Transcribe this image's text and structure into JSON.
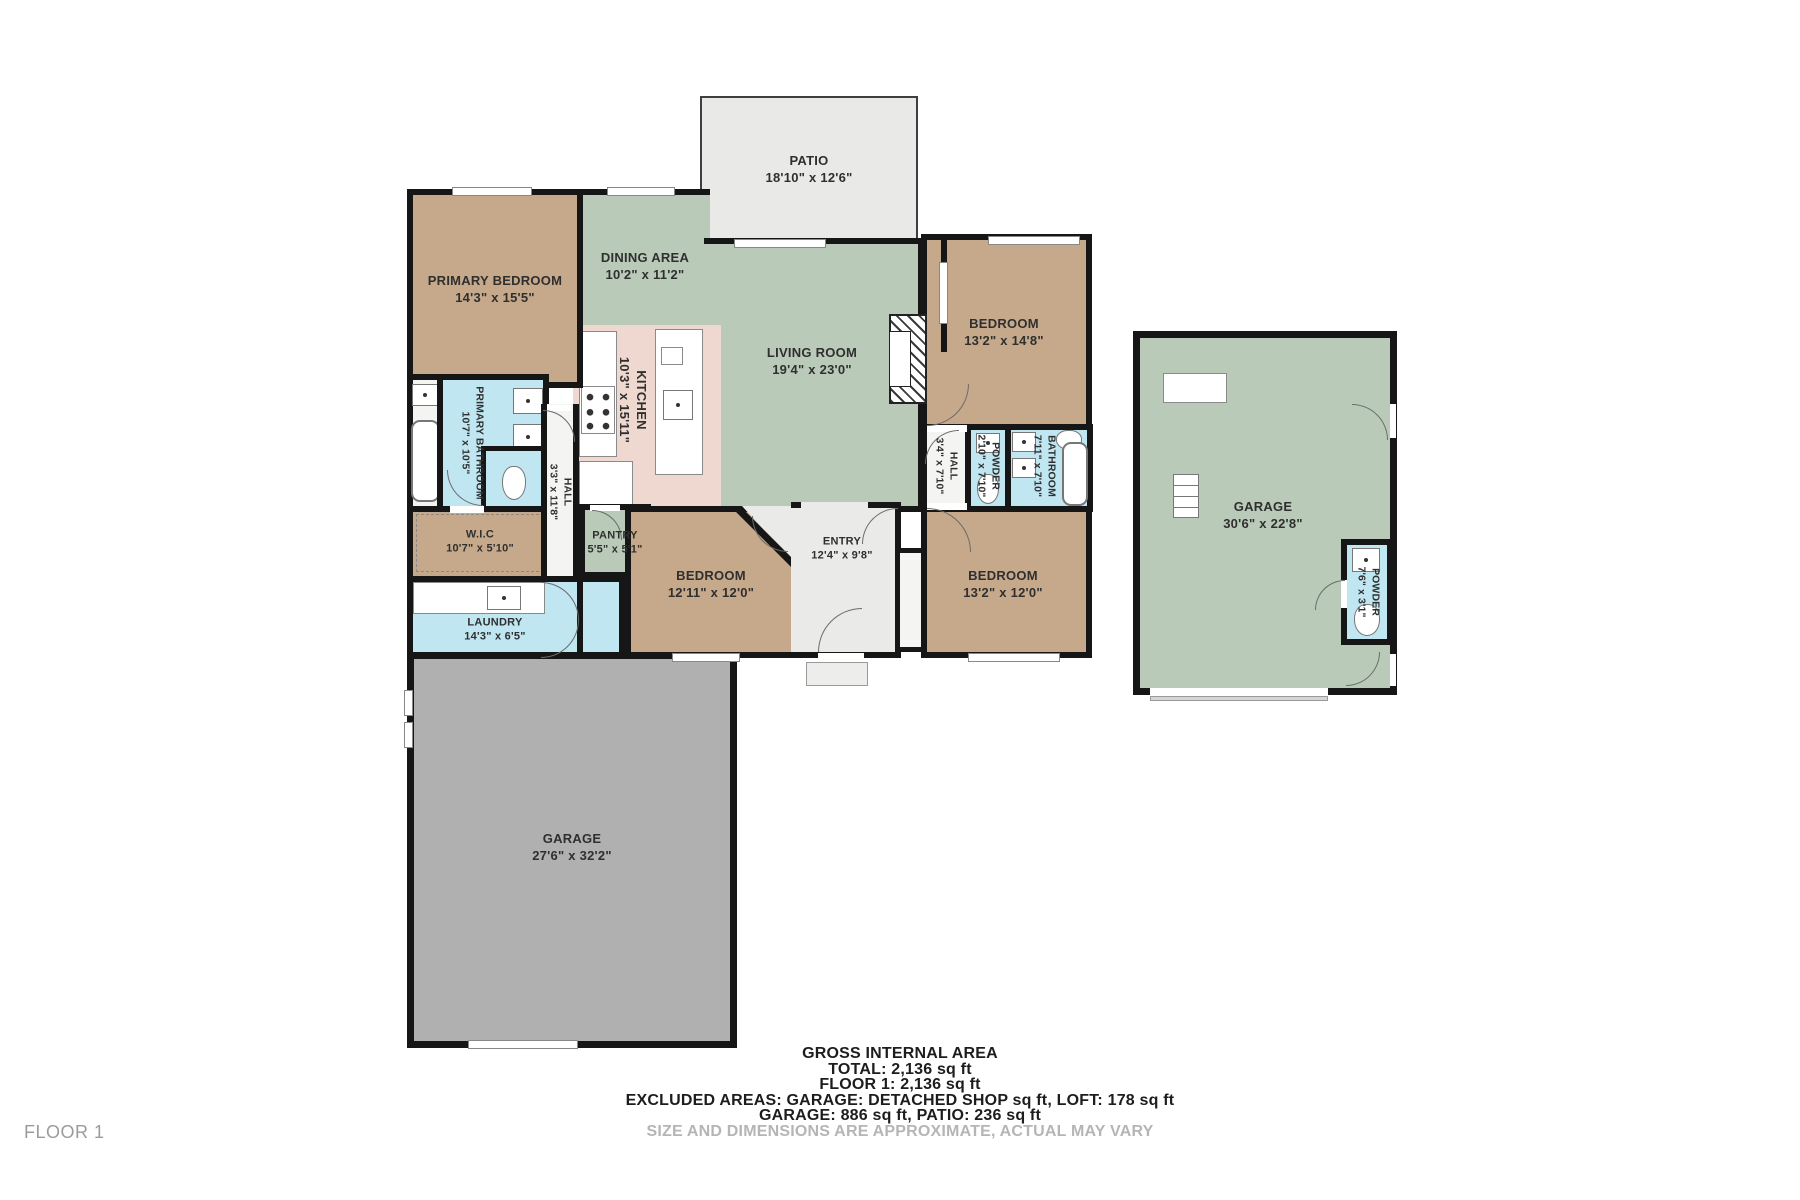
{
  "floor_label": "FLOOR 1",
  "footer": {
    "line1": "GROSS INTERNAL AREA",
    "line2": "TOTAL: 2,136 sq ft",
    "line3": "FLOOR 1: 2,136 sq ft",
    "line4": "EXCLUDED AREAS: GARAGE: DETACHED SHOP sq ft, LOFT: 178 sq ft",
    "line5": "GARAGE: 886 sq ft, PATIO: 236 sq ft",
    "disclaimer": "SIZE AND DIMENSIONS ARE APPROXIMATE, ACTUAL MAY VARY"
  },
  "rooms": {
    "patio": {
      "name": "PATIO",
      "dims": "18'10\" x 12'6\""
    },
    "primary_bedroom": {
      "name": "PRIMARY BEDROOM",
      "dims": "14'3\" x 15'5\""
    },
    "dining": {
      "name": "DINING AREA",
      "dims": "10'2\" x 11'2\""
    },
    "living": {
      "name": "LIVING ROOM",
      "dims": "19'4\" x 23'0\""
    },
    "kitchen": {
      "name": "KITCHEN",
      "dims": "10'3\" x 15'11\""
    },
    "primary_bathroom": {
      "name": "PRIMARY BATHROOM",
      "dims": "10'7\" x 10'5\""
    },
    "wic": {
      "name": "W.I.C",
      "dims": "10'7\" x 5'10\""
    },
    "hall_main": {
      "name": "HALL",
      "dims": "3'3\" x 11'8\""
    },
    "pantry": {
      "name": "PANTRY",
      "dims": "5'5\" x 5'1\""
    },
    "laundry": {
      "name": "LAUNDRY",
      "dims": "14'3\" x 6'5\""
    },
    "bedroom_sw": {
      "name": "BEDROOM",
      "dims": "12'11\" x 12'0\""
    },
    "entry": {
      "name": "ENTRY",
      "dims": "12'4\" x 9'8\""
    },
    "bedroom_se": {
      "name": "BEDROOM",
      "dims": "13'2\" x 12'0\""
    },
    "bedroom_ne": {
      "name": "BEDROOM",
      "dims": "13'2\" x 14'8\""
    },
    "hall_east": {
      "name": "HALL",
      "dims": "3'4\" x 7'10\""
    },
    "powder_east": {
      "name": "POWDER",
      "dims": "2'10\" x 7'10\""
    },
    "bathroom_east": {
      "name": "BATHROOM",
      "dims": "7'11\" x 7'10\""
    },
    "garage_detached": {
      "name": "GARAGE",
      "dims": "30'6\" x 22'8\""
    },
    "powder_garage": {
      "name": "POWDER",
      "dims": "7'6\" x 3'1\""
    },
    "garage_attached": {
      "name": "GARAGE",
      "dims": "27'6\" x 32'2\""
    }
  },
  "colors": {
    "wall": "#161616",
    "tan": "#c6a98b",
    "green": "#b9cbb8",
    "blue": "#bfe6f1",
    "pink": "#eed8d0",
    "patio": "#e9e9e7",
    "entry": "#eaeae8",
    "garage_gray": "#b0b0b0",
    "white_room": "#f4f4f2",
    "label": "#2f2f2f",
    "muted": "#b5b5b5",
    "footer": "#1d1d1d"
  }
}
